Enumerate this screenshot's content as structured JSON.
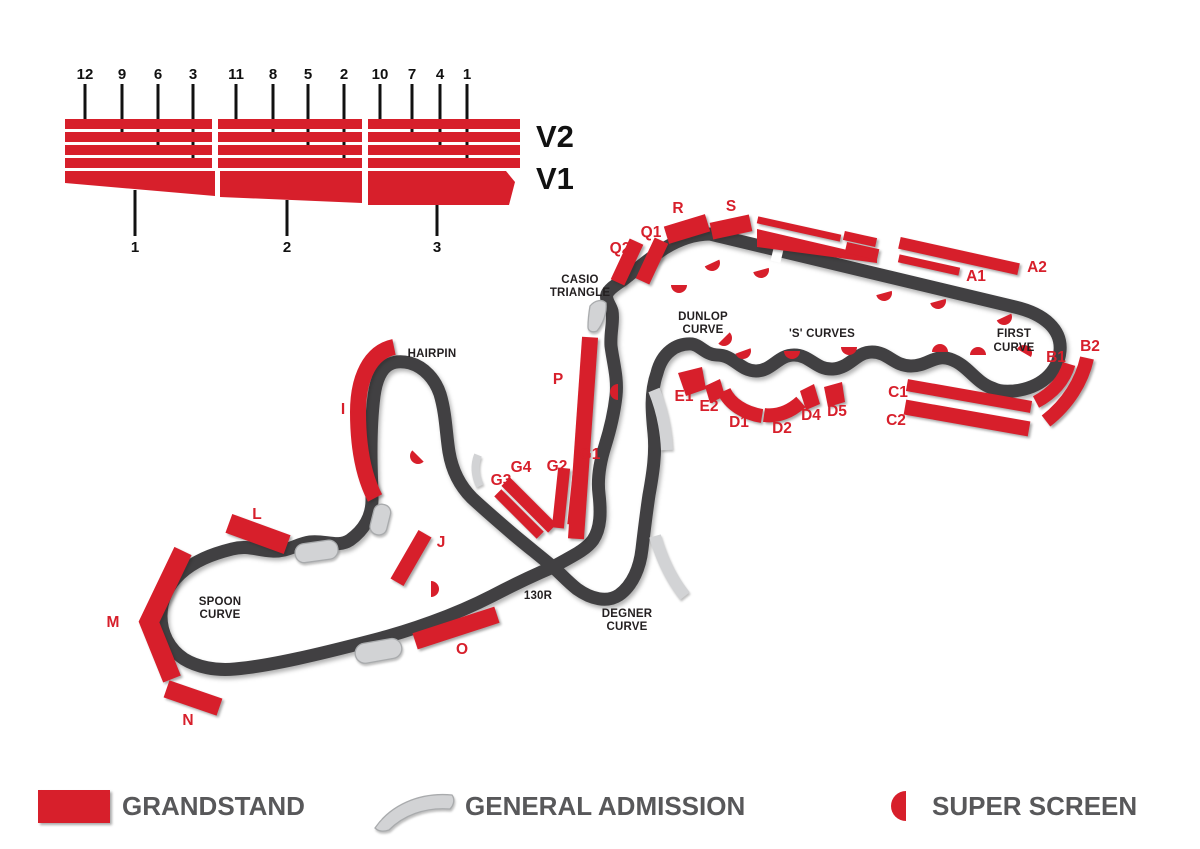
{
  "colors": {
    "red": "#d71f2b",
    "track": "#414042",
    "ga": "#d2d3d5",
    "gaStroke": "#a9abad",
    "black": "#231f20",
    "legendText": "#58585a"
  },
  "pit_diagram": {
    "v2_label": "V2",
    "v1_label": "V1",
    "top_numbers": [
      "12",
      "9",
      "6",
      "3",
      "11",
      "8",
      "5",
      "2",
      "10",
      "7",
      "4",
      "1"
    ],
    "bottom_numbers": [
      "1",
      "2",
      "3"
    ]
  },
  "corners": {
    "casio": [
      "CASIO",
      "TRIANGLE"
    ],
    "dunlop": [
      "DUNLOP",
      "CURVE"
    ],
    "s_curves": [
      "'S' CURVES"
    ],
    "first": [
      "FIRST",
      "CURVE"
    ],
    "hairpin": [
      "HAIRPIN"
    ],
    "spoon": [
      "SPOON",
      "CURVE"
    ],
    "degner": [
      "DEGNER",
      "CURVE"
    ],
    "r130": [
      "130R"
    ]
  },
  "stands": {
    "labels": [
      "R",
      "S",
      "Q1",
      "Q2",
      "A1",
      "A2",
      "B1",
      "B2",
      "C1",
      "C2",
      "D1",
      "D2",
      "D4",
      "D5",
      "E1",
      "E2",
      "G1",
      "G2",
      "G3",
      "G4",
      "P",
      "I",
      "J",
      "L",
      "M",
      "N",
      "O"
    ]
  },
  "legend": {
    "items": [
      {
        "label": "GRANDSTAND",
        "icon": "grandstand-swatch"
      },
      {
        "label": "GENERAL ADMISSION",
        "icon": "general-admission-swatch"
      },
      {
        "label": "SUPER SCREEN",
        "icon": "super-screen-swatch"
      }
    ]
  }
}
